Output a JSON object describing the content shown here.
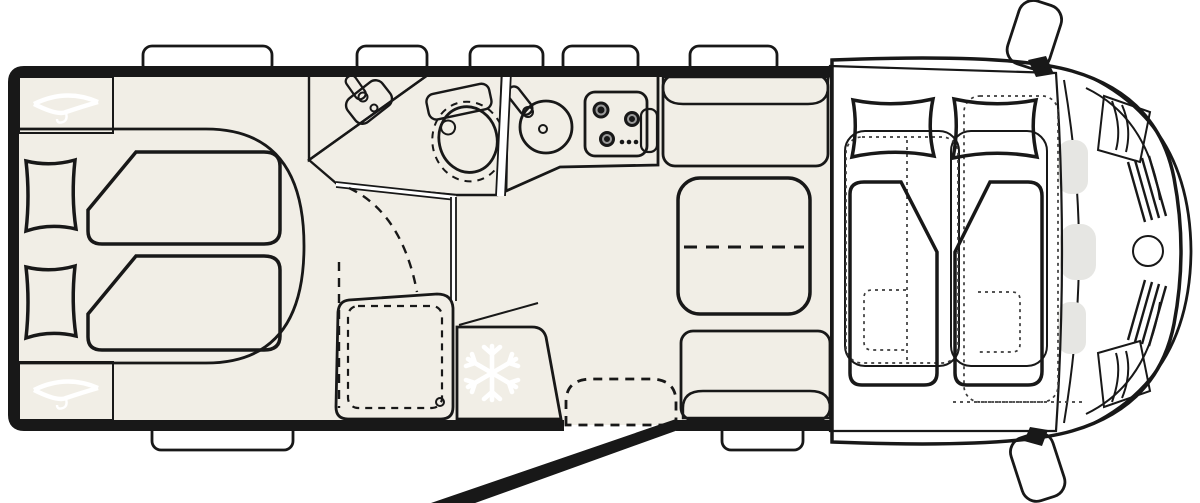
{
  "document": {
    "kind": "motorhome floor plan, top-down view",
    "orientation": "driver cab at right, rear bedroom at left",
    "visible_text": "none"
  },
  "rooms": [
    {
      "name": "rear twin bedroom",
      "features": [
        "two single beds with pillows and folded duvets",
        "rounded bed platform",
        "two wardrobes with clothes-hanger icons"
      ]
    },
    {
      "name": "washroom",
      "features": [
        "corner vanity with washbasin and faucet",
        "cassette toilet with dashed lid outline",
        "dashed door swing lines"
      ]
    },
    {
      "name": "shower",
      "features": [
        "shower tray with dashed inner tray outline and drain"
      ]
    },
    {
      "name": "kitchen",
      "features": [
        "round sink with faucet",
        "3-burner gas hob with control knobs",
        "counter box",
        "fridge with snowflake icon"
      ]
    },
    {
      "name": "dinette",
      "features": [
        "two bench seats with backrests",
        "extendable table with dashed extension line"
      ]
    },
    {
      "name": "entryway",
      "features": [
        "entry step with dashed outline",
        "open entry door leaf drawn outside body"
      ]
    },
    {
      "name": "cab / drop-down bed",
      "features": [
        "drop-down bed with two pillows and two duvets",
        "dotted outlines of swivel cab seats",
        "windshield",
        "dashboard panels",
        "front grille slats",
        "round brand logo",
        "two exterior side mirrors"
      ]
    }
  ],
  "icons": {
    "wardrobe_icon": "clothes-hanger",
    "fridge_icon": "snowflake",
    "hob_icon": "three burner rings with three knob dots",
    "brand_logo": "gray circle with white swirl on front grille"
  },
  "counts": {
    "roof_windows_top_wall": 5,
    "windows_bottom_wall": 2,
    "beds_rear": 2,
    "beds_drop_down": 2,
    "hob_burners": 3,
    "side_mirrors": 2,
    "wardrobes": 2
  },
  "colors": {
    "wall": "#181818",
    "floor": "#f1eee6",
    "platform": "#eae6da",
    "tan": "#e9b97e",
    "furngray": "#c8c8c5",
    "bench": "#c5c7c3",
    "seat": "#e7e3da",
    "blue": "#dde7f3",
    "blue2": "#dbe5f1",
    "vanity": "#d8d9db",
    "white": "#ffffff",
    "step": "#e3e0d7",
    "cabint": "#ebe6da",
    "cabbody": "#f6f6f4",
    "glass": "#c7c9c6",
    "dashpanel": "#e6e6e3",
    "logogray": "#9aa0a1"
  }
}
